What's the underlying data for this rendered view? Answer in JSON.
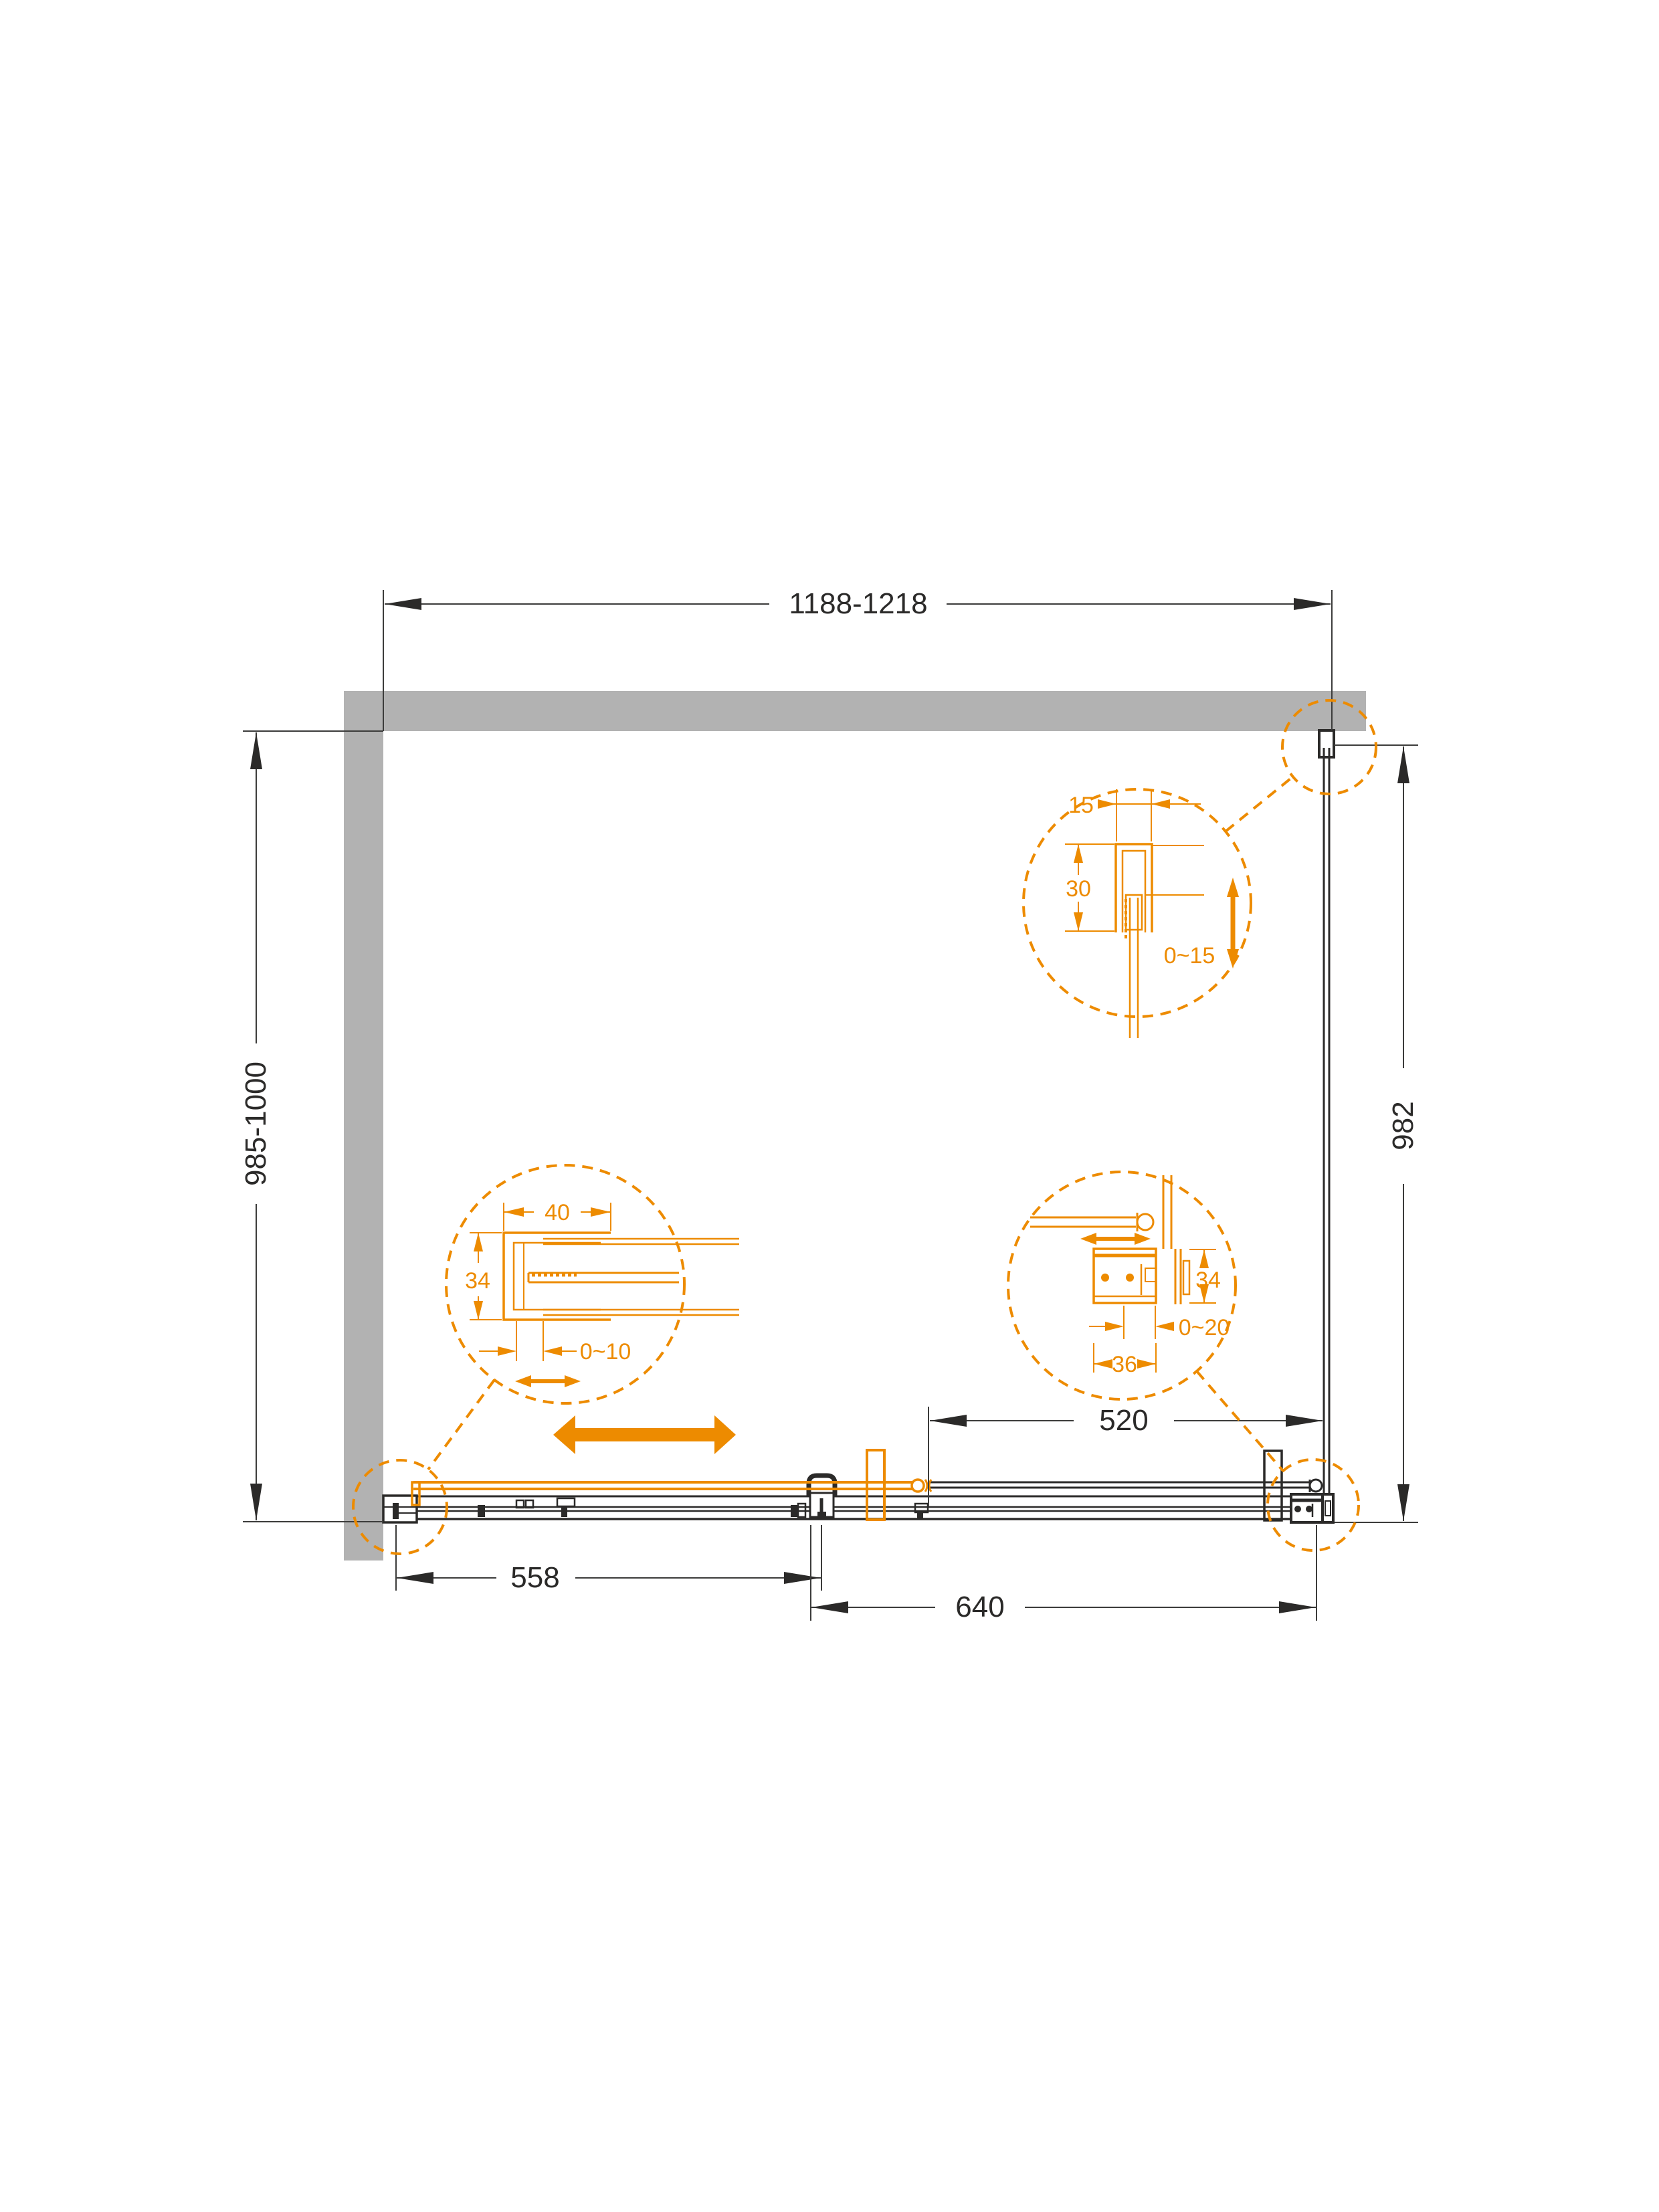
{
  "drawing": {
    "dims": {
      "width": "1188-1218",
      "height_left": "985-1000",
      "height_right": "982",
      "door": "558",
      "fixed": "640",
      "opening": "520"
    },
    "detail_top_right": {
      "w": "15",
      "d": "30",
      "range": "0~15"
    },
    "detail_left": {
      "w": "40",
      "h": "34",
      "range": "0~10"
    },
    "detail_right": {
      "h": "34",
      "range": "0~20",
      "w": "36"
    },
    "colors": {
      "accent": "#ED8B00",
      "wall": "#B2B2B2",
      "line": "#2B2A29",
      "dim_line": "#3C3C3B"
    }
  }
}
